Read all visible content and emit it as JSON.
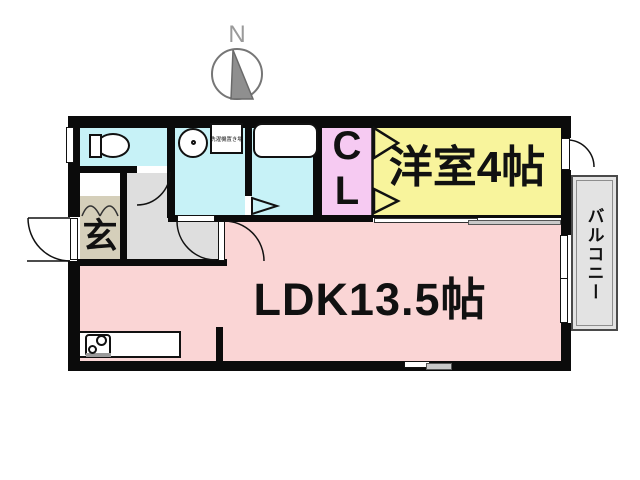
{
  "compass": {
    "north_label": "N"
  },
  "rooms": {
    "ldk": {
      "label": "LDK13.5帖",
      "color": "#FAD5D5"
    },
    "western_room": {
      "label": "洋室4帖",
      "color": "#F8F49C"
    },
    "closet": {
      "letter1": "C",
      "letter2": "L",
      "color": "#F6CAF2"
    },
    "balcony": {
      "label": "バルコニー",
      "color": "#E3E3E3"
    },
    "entrance": {
      "label": "玄",
      "color": "#D5CFBA"
    },
    "hallway": {
      "color": "#DEDEDE"
    },
    "toilet": {
      "color": "#C7F2F7"
    },
    "washroom": {
      "color": "#C7F2F7",
      "laundry_label": "洗濯機置き場"
    },
    "bathroom": {
      "color": "#C7F2F7"
    }
  },
  "wall_color": "#0b0b0b"
}
